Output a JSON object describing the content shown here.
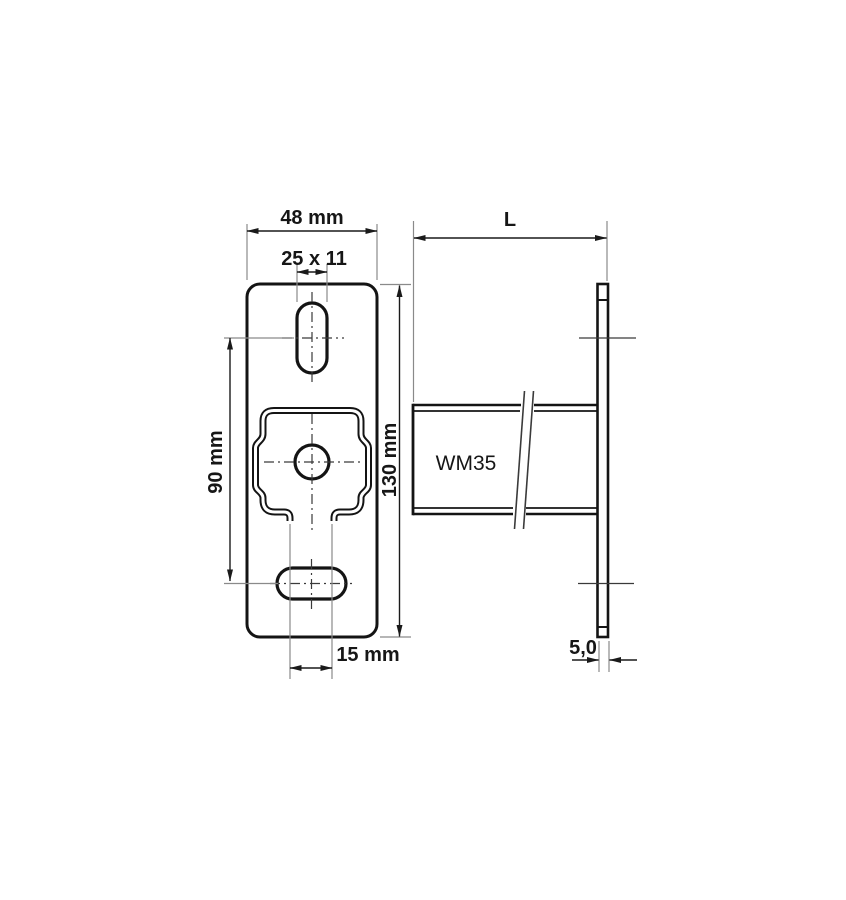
{
  "drawing": {
    "background_color": "#ffffff",
    "outline_color": "#141414",
    "extension_line_color": "#8a8a8a",
    "front_view": {
      "dim_width": "48 mm",
      "dim_top_slot": "25 x 11",
      "dim_slot_spacing": "90 mm",
      "dim_height": "130 mm",
      "dim_bottom_opening": "15 mm"
    },
    "side_view": {
      "product_label": "WM35",
      "dim_length": "L",
      "dim_thickness": "5,0"
    }
  }
}
